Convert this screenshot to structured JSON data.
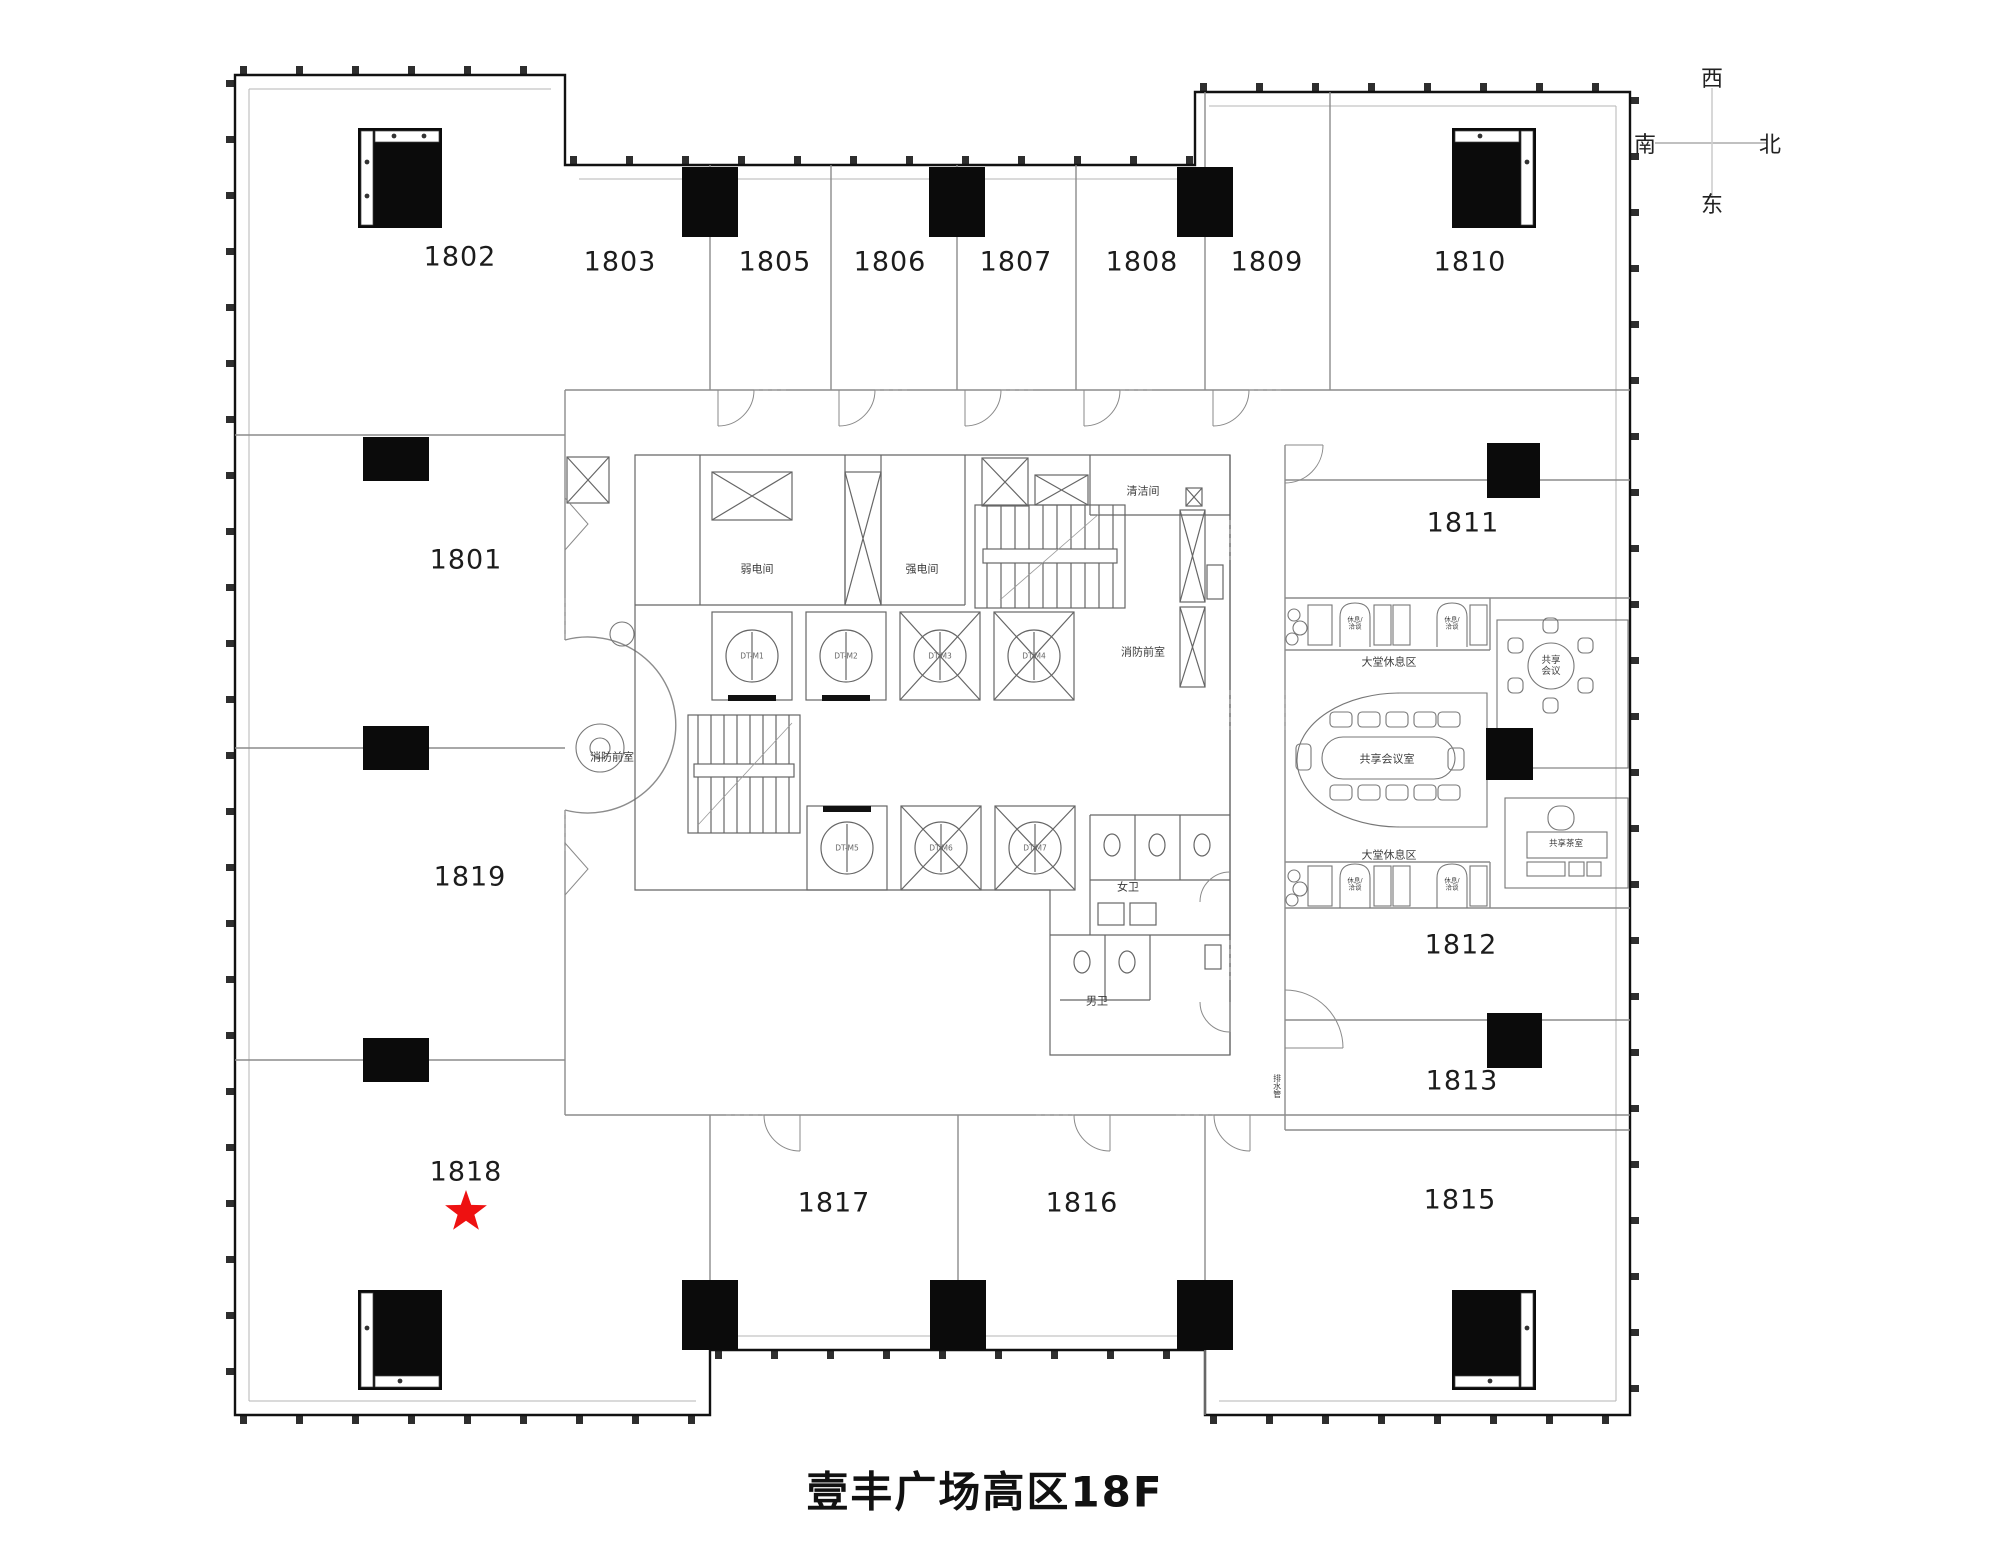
{
  "page_title": "壹丰广场高区18F",
  "compass": {
    "top": "西",
    "left": "南",
    "right": "北",
    "bottom": "东"
  },
  "highlight": {
    "unit": "1818",
    "symbol": "red-star",
    "color": "#ee1111",
    "x": 466,
    "y": 1212
  },
  "rooms": [
    {
      "label": "1802",
      "x": 460,
      "y": 257
    },
    {
      "label": "1803",
      "x": 620,
      "y": 262
    },
    {
      "label": "1805",
      "x": 775,
      "y": 262
    },
    {
      "label": "1806",
      "x": 890,
      "y": 262
    },
    {
      "label": "1807",
      "x": 1016,
      "y": 262
    },
    {
      "label": "1808",
      "x": 1142,
      "y": 262
    },
    {
      "label": "1809",
      "x": 1267,
      "y": 262
    },
    {
      "label": "1810",
      "x": 1470,
      "y": 262
    },
    {
      "label": "1801",
      "x": 466,
      "y": 560
    },
    {
      "label": "1811",
      "x": 1463,
      "y": 523
    },
    {
      "label": "1819",
      "x": 470,
      "y": 877
    },
    {
      "label": "1812",
      "x": 1461,
      "y": 945
    },
    {
      "label": "1813",
      "x": 1462,
      "y": 1081
    },
    {
      "label": "1818",
      "x": 466,
      "y": 1172
    },
    {
      "label": "1817",
      "x": 834,
      "y": 1203
    },
    {
      "label": "1816",
      "x": 1082,
      "y": 1203
    },
    {
      "label": "1815",
      "x": 1460,
      "y": 1200
    }
  ],
  "plan_labels": [
    {
      "text": "弱电间",
      "x": 757,
      "y": 570,
      "size": 11
    },
    {
      "text": "强电间",
      "x": 922,
      "y": 570,
      "size": 11
    },
    {
      "text": "清洁间",
      "x": 1143,
      "y": 492,
      "size": 11
    },
    {
      "text": "消防前室",
      "x": 1143,
      "y": 653,
      "size": 11
    },
    {
      "text": "消防前室",
      "x": 612,
      "y": 758,
      "size": 11
    },
    {
      "text": "女卫",
      "x": 1128,
      "y": 888,
      "size": 11
    },
    {
      "text": "男卫",
      "x": 1097,
      "y": 1002,
      "size": 11
    },
    {
      "text": "共享会议室",
      "x": 1387,
      "y": 760,
      "size": 11
    },
    {
      "text": "共享会议",
      "x": 1551,
      "y": 667,
      "size": 9.5,
      "lines": [
        "共享",
        "会议"
      ]
    },
    {
      "text": "共享茶室",
      "x": 1566,
      "y": 845,
      "size": 8.5
    },
    {
      "text": "大堂休息区",
      "x": 1389,
      "y": 663,
      "size": 11
    },
    {
      "text": "大堂休息区",
      "x": 1389,
      "y": 856,
      "size": 11
    },
    {
      "text": "休息/洽谈",
      "x": 1355,
      "y": 624,
      "size": 6.5,
      "lines": [
        "休息/",
        "洽谈"
      ]
    },
    {
      "text": "休息/洽谈",
      "x": 1452,
      "y": 624,
      "size": 6.5,
      "lines": [
        "休息/",
        "洽谈"
      ]
    },
    {
      "text": "休息/洽谈",
      "x": 1355,
      "y": 885,
      "size": 6.5,
      "lines": [
        "休息/",
        "洽谈"
      ]
    },
    {
      "text": "休息/洽谈",
      "x": 1452,
      "y": 885,
      "size": 6.5,
      "lines": [
        "休息/",
        "洽谈"
      ]
    },
    {
      "text": "排水管",
      "x": 1277,
      "y": 1086,
      "size": 8,
      "vertical": true
    }
  ],
  "elevator_tags": [
    {
      "text": "DT-M1",
      "x": 752,
      "y": 656
    },
    {
      "text": "DT-M2",
      "x": 846,
      "y": 656
    },
    {
      "text": "DT-M3",
      "x": 940,
      "y": 656
    },
    {
      "text": "DT-M4",
      "x": 1034,
      "y": 656
    },
    {
      "text": "DT-M5",
      "x": 847,
      "y": 848
    },
    {
      "text": "DT-M6",
      "x": 941,
      "y": 848
    },
    {
      "text": "DT-M7",
      "x": 1035,
      "y": 848
    }
  ]
}
